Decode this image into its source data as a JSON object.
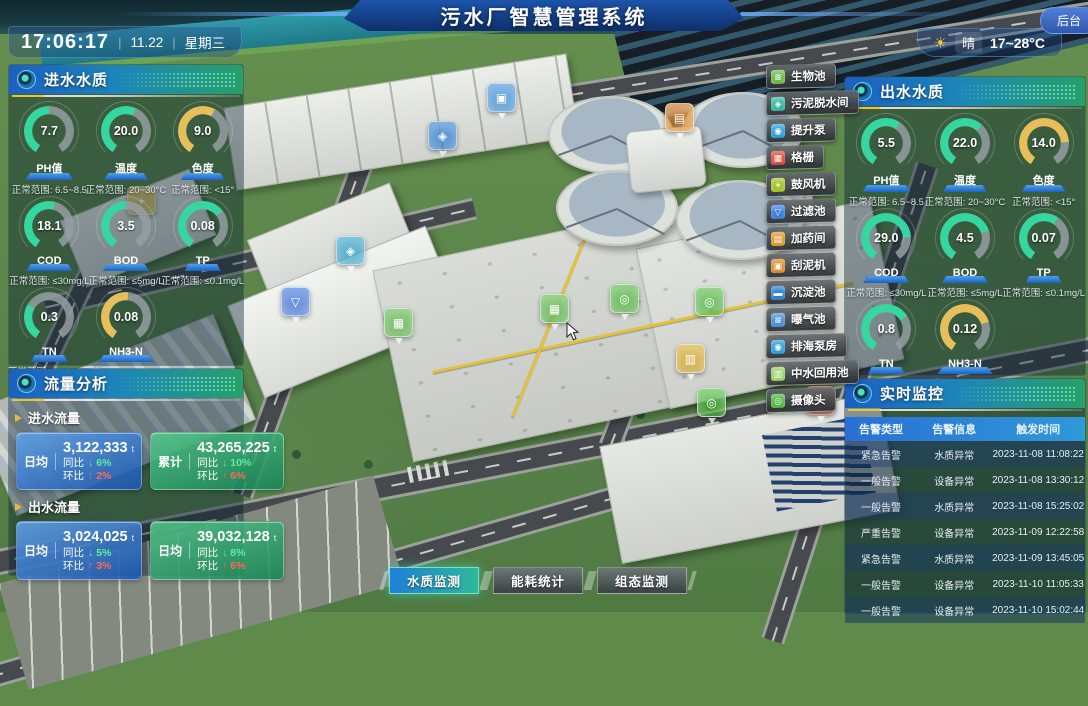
{
  "header": {
    "title": "污水厂智慧管理系统",
    "clock": {
      "time": "17:06:17",
      "date": "11.22",
      "weekday": "星期三"
    },
    "weather": {
      "condition": "晴",
      "temp_range": "17~28°C"
    },
    "backend_label": "后台"
  },
  "panels": {
    "inlet_quality": {
      "title": "进水水质",
      "gauges": [
        {
          "label": "PH值",
          "value": "7.7",
          "range": "正常范围: 6.5~8.5",
          "percent": 50,
          "color": "#35d6a0"
        },
        {
          "label": "温度",
          "value": "20.0",
          "range": "正常范围: 20~30°C",
          "percent": 58,
          "color": "#35d6a0"
        },
        {
          "label": "色度",
          "value": "9.0",
          "range": "正常范围: <15°",
          "percent": 60,
          "color": "#e6bf5a"
        },
        {
          "label": "COD",
          "value": "18.1",
          "range": "正常范围: ≤30mg/L",
          "percent": 55,
          "color": "#35d6a0"
        },
        {
          "label": "BOD",
          "value": "3.5",
          "range": "正常范围: ≤5mg/L",
          "percent": 50,
          "color": "#35d6a0"
        },
        {
          "label": "TP",
          "value": "0.08",
          "range": "正常范围: ≤0.1mg/L",
          "percent": 68,
          "color": "#35d6a0"
        },
        {
          "label": "TN",
          "value": "0.3",
          "range": "正常范围: ≤1.0mg/L",
          "percent": 30,
          "color": "#35d6a0"
        },
        {
          "label": "NH3-N",
          "value": "0.08",
          "range": "正常范围: ≤0.15mg/L",
          "percent": 52,
          "color": "#e6bf5a"
        }
      ]
    },
    "flow_analysis": {
      "title": "流量分析",
      "unit": "t",
      "yoy_label": "同比",
      "mom_label": "环比",
      "sections": [
        {
          "title": "进水流量",
          "cards": [
            {
              "label": "日均",
              "value": "3,122,333",
              "yoy": "6%",
              "mom": "2%",
              "style": "blue"
            },
            {
              "label": "累计",
              "value": "43,265,225",
              "yoy": "10%",
              "mom": "6%",
              "style": "green"
            }
          ]
        },
        {
          "title": "出水流量",
          "cards": [
            {
              "label": "日均",
              "value": "3,024,025",
              "yoy": "5%",
              "mom": "3%",
              "style": "blue"
            },
            {
              "label": "日均",
              "value": "39,032,128",
              "yoy": "8%",
              "mom": "6%",
              "style": "green"
            }
          ]
        }
      ]
    },
    "outlet_quality": {
      "title": "出水水质",
      "gauges": [
        {
          "label": "PH值",
          "value": "5.5",
          "range": "正常范围: 6.5~8.5",
          "percent": 62,
          "color": "#35d6a0"
        },
        {
          "label": "温度",
          "value": "22.0",
          "range": "正常范围: 20~30°C",
          "percent": 65,
          "color": "#35d6a0"
        },
        {
          "label": "色度",
          "value": "14.0",
          "range": "正常范围: <15°",
          "percent": 80,
          "color": "#e6bf5a"
        },
        {
          "label": "COD",
          "value": "29.0",
          "range": "正常范围: ≤30mg/L",
          "percent": 80,
          "color": "#35d6a0"
        },
        {
          "label": "BOD",
          "value": "4.5",
          "range": "正常范围: ≤5mg/L",
          "percent": 75,
          "color": "#35d6a0"
        },
        {
          "label": "TP",
          "value": "0.07",
          "range": "正常范围: ≤0.1mg/L",
          "percent": 62,
          "color": "#35d6a0"
        },
        {
          "label": "TN",
          "value": "0.8",
          "range": "正常范围: ≤1.0mg/L",
          "percent": 70,
          "color": "#35d6a0"
        },
        {
          "label": "NH3-N",
          "value": "0.12",
          "range": "正常范围: ≤0.15mg/L",
          "percent": 75,
          "color": "#e6bf5a"
        }
      ]
    },
    "monitoring": {
      "title": "实时监控",
      "columns": [
        "告警类型",
        "告警信息",
        "触发时间"
      ],
      "rows": [
        [
          "紧急告警",
          "水质异常",
          "2023-11-08 11:08:22"
        ],
        [
          "一般告警",
          "设备异常",
          "2023-11-08 13:30:12"
        ],
        [
          "一般告警",
          "水质异常",
          "2023-11-08 15:25:02"
        ],
        [
          "严重告警",
          "设备异常",
          "2023-11-09 12:22:58"
        ],
        [
          "紧急告警",
          "水质异常",
          "2023-11-09 13:45:05"
        ],
        [
          "一般告警",
          "设备异常",
          "2023-11-10 11:05:33"
        ],
        [
          "一般告警",
          "设备异常",
          "2023-11-10 15:02:44"
        ]
      ]
    }
  },
  "facility_menu": [
    {
      "label": "生物池",
      "color": "#6cbd45",
      "glyph": "≋",
      "name": "bio-pool"
    },
    {
      "label": "污泥脱水间",
      "color": "#35b8a0",
      "glyph": "◈",
      "name": "sludge-dewatering"
    },
    {
      "label": "提升泵",
      "color": "#2e9fd8",
      "glyph": "◉",
      "name": "lift-pump"
    },
    {
      "label": "格栅",
      "color": "#d84a3a",
      "glyph": "▦",
      "name": "bar-screen"
    },
    {
      "label": "鼓风机",
      "color": "#a8c22e",
      "glyph": "+",
      "name": "blower"
    },
    {
      "label": "过滤池",
      "color": "#3a7fe0",
      "glyph": "▽",
      "name": "filter-pool"
    },
    {
      "label": "加药间",
      "color": "#e0952e",
      "glyph": "▤",
      "name": "dosing-room"
    },
    {
      "label": "刮泥机",
      "color": "#e08a28",
      "glyph": "▣",
      "name": "mud-scraper"
    },
    {
      "label": "沉淀池",
      "color": "#2e7fd8",
      "glyph": "▬",
      "name": "sedimentation-pool"
    },
    {
      "label": "曝气池",
      "color": "#4a90d8",
      "glyph": "≋",
      "name": "aeration-pool"
    },
    {
      "label": "排海泵房",
      "color": "#2e9fd8",
      "glyph": "◉",
      "name": "sea-discharge-pump"
    },
    {
      "label": "中水回用池",
      "color": "#9ad060",
      "glyph": "▥",
      "name": "water-reuse-pool"
    },
    {
      "label": "摄像头",
      "color": "#50b840",
      "glyph": "◎",
      "name": "camera"
    }
  ],
  "bottom_tabs": [
    {
      "label": "水质监测",
      "active": true
    },
    {
      "label": "能耗统计",
      "active": false
    },
    {
      "label": "组态监测",
      "active": false
    }
  ],
  "scene": {
    "icons": [
      {
        "x": 487,
        "y": 83,
        "color": "#3a8fd8",
        "glyph": "▣",
        "name": "sedimentation"
      },
      {
        "x": 428,
        "y": 121,
        "color": "#2e7fd0",
        "glyph": "◈",
        "name": "pump-station"
      },
      {
        "x": 665,
        "y": 103,
        "color": "#e08a30",
        "glyph": "▤",
        "name": "dosing"
      },
      {
        "x": 127,
        "y": 186,
        "color": "#d8b830",
        "glyph": "+",
        "name": "blower"
      },
      {
        "x": 336,
        "y": 236,
        "color": "#30a0c8",
        "glyph": "◈",
        "name": "equipment"
      },
      {
        "x": 281,
        "y": 287,
        "color": "#3a6fd8",
        "glyph": "▽",
        "name": "filter"
      },
      {
        "x": 384,
        "y": 308,
        "color": "#5ab848",
        "glyph": "▦",
        "name": "bio-pool-1"
      },
      {
        "x": 540,
        "y": 294,
        "color": "#5ab848",
        "glyph": "▦",
        "name": "bio-pool-2"
      },
      {
        "x": 610,
        "y": 284,
        "color": "#50b840",
        "glyph": "◎",
        "name": "camera-1"
      },
      {
        "x": 695,
        "y": 287,
        "color": "#50b840",
        "glyph": "◎",
        "name": "camera-2"
      },
      {
        "x": 676,
        "y": 344,
        "color": "#d8a828",
        "glyph": "▥",
        "name": "yellow-unit"
      },
      {
        "x": 697,
        "y": 388,
        "color": "#50b840",
        "glyph": "◎",
        "name": "camera-3"
      },
      {
        "x": 806,
        "y": 386,
        "color": "#d83a30",
        "glyph": "!",
        "name": "alarm"
      }
    ]
  }
}
